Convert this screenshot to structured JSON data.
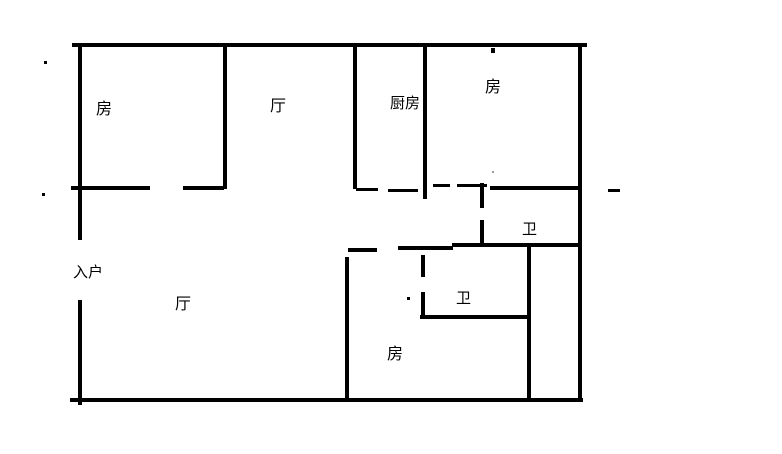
{
  "floorplan": {
    "background_color": "#ffffff",
    "wall_color": "#000000",
    "labels": {
      "bedroom_top_left": "房",
      "hall_top": "厅",
      "kitchen": "厨房",
      "bedroom_top_right": "房",
      "entrance": "入户",
      "hall_main": "厅",
      "bath_top": "卫",
      "bath_bottom": "卫",
      "bedroom_bottom": "房"
    }
  }
}
